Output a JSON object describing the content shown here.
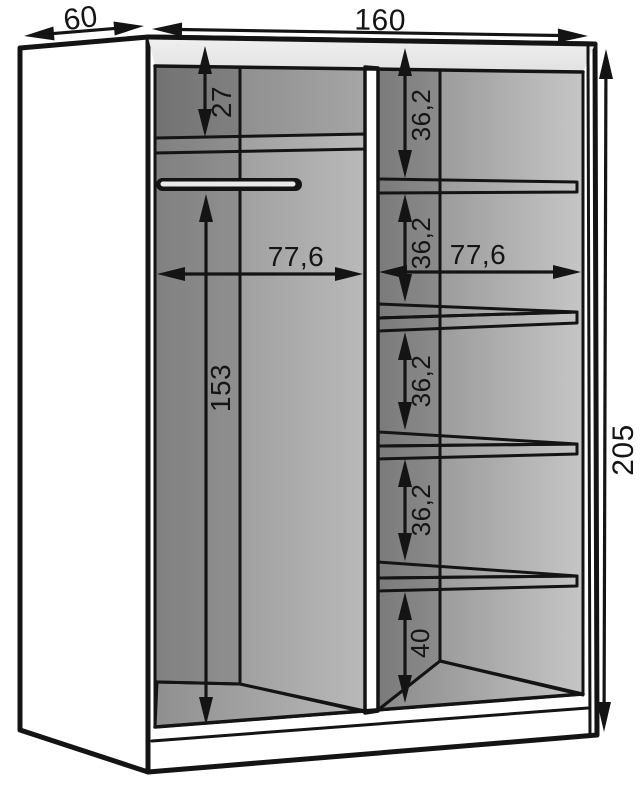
{
  "diagram": {
    "labels": {
      "depth": "60",
      "width": "160",
      "height": "205",
      "top_gap": "27",
      "left_width": "77,6",
      "right_width": "77,6",
      "hanging_height": "153",
      "shelf_gap": "36,2",
      "bottom_gap": "40"
    },
    "colors": {
      "line": "#141414",
      "panel_face": "#ececec",
      "interior_dark": "#8c8c8c",
      "interior_light": "#c6c6c6",
      "floor": "#d6d6d6",
      "shelf_face": "#f2f2f2",
      "background": "#ffffff"
    }
  }
}
